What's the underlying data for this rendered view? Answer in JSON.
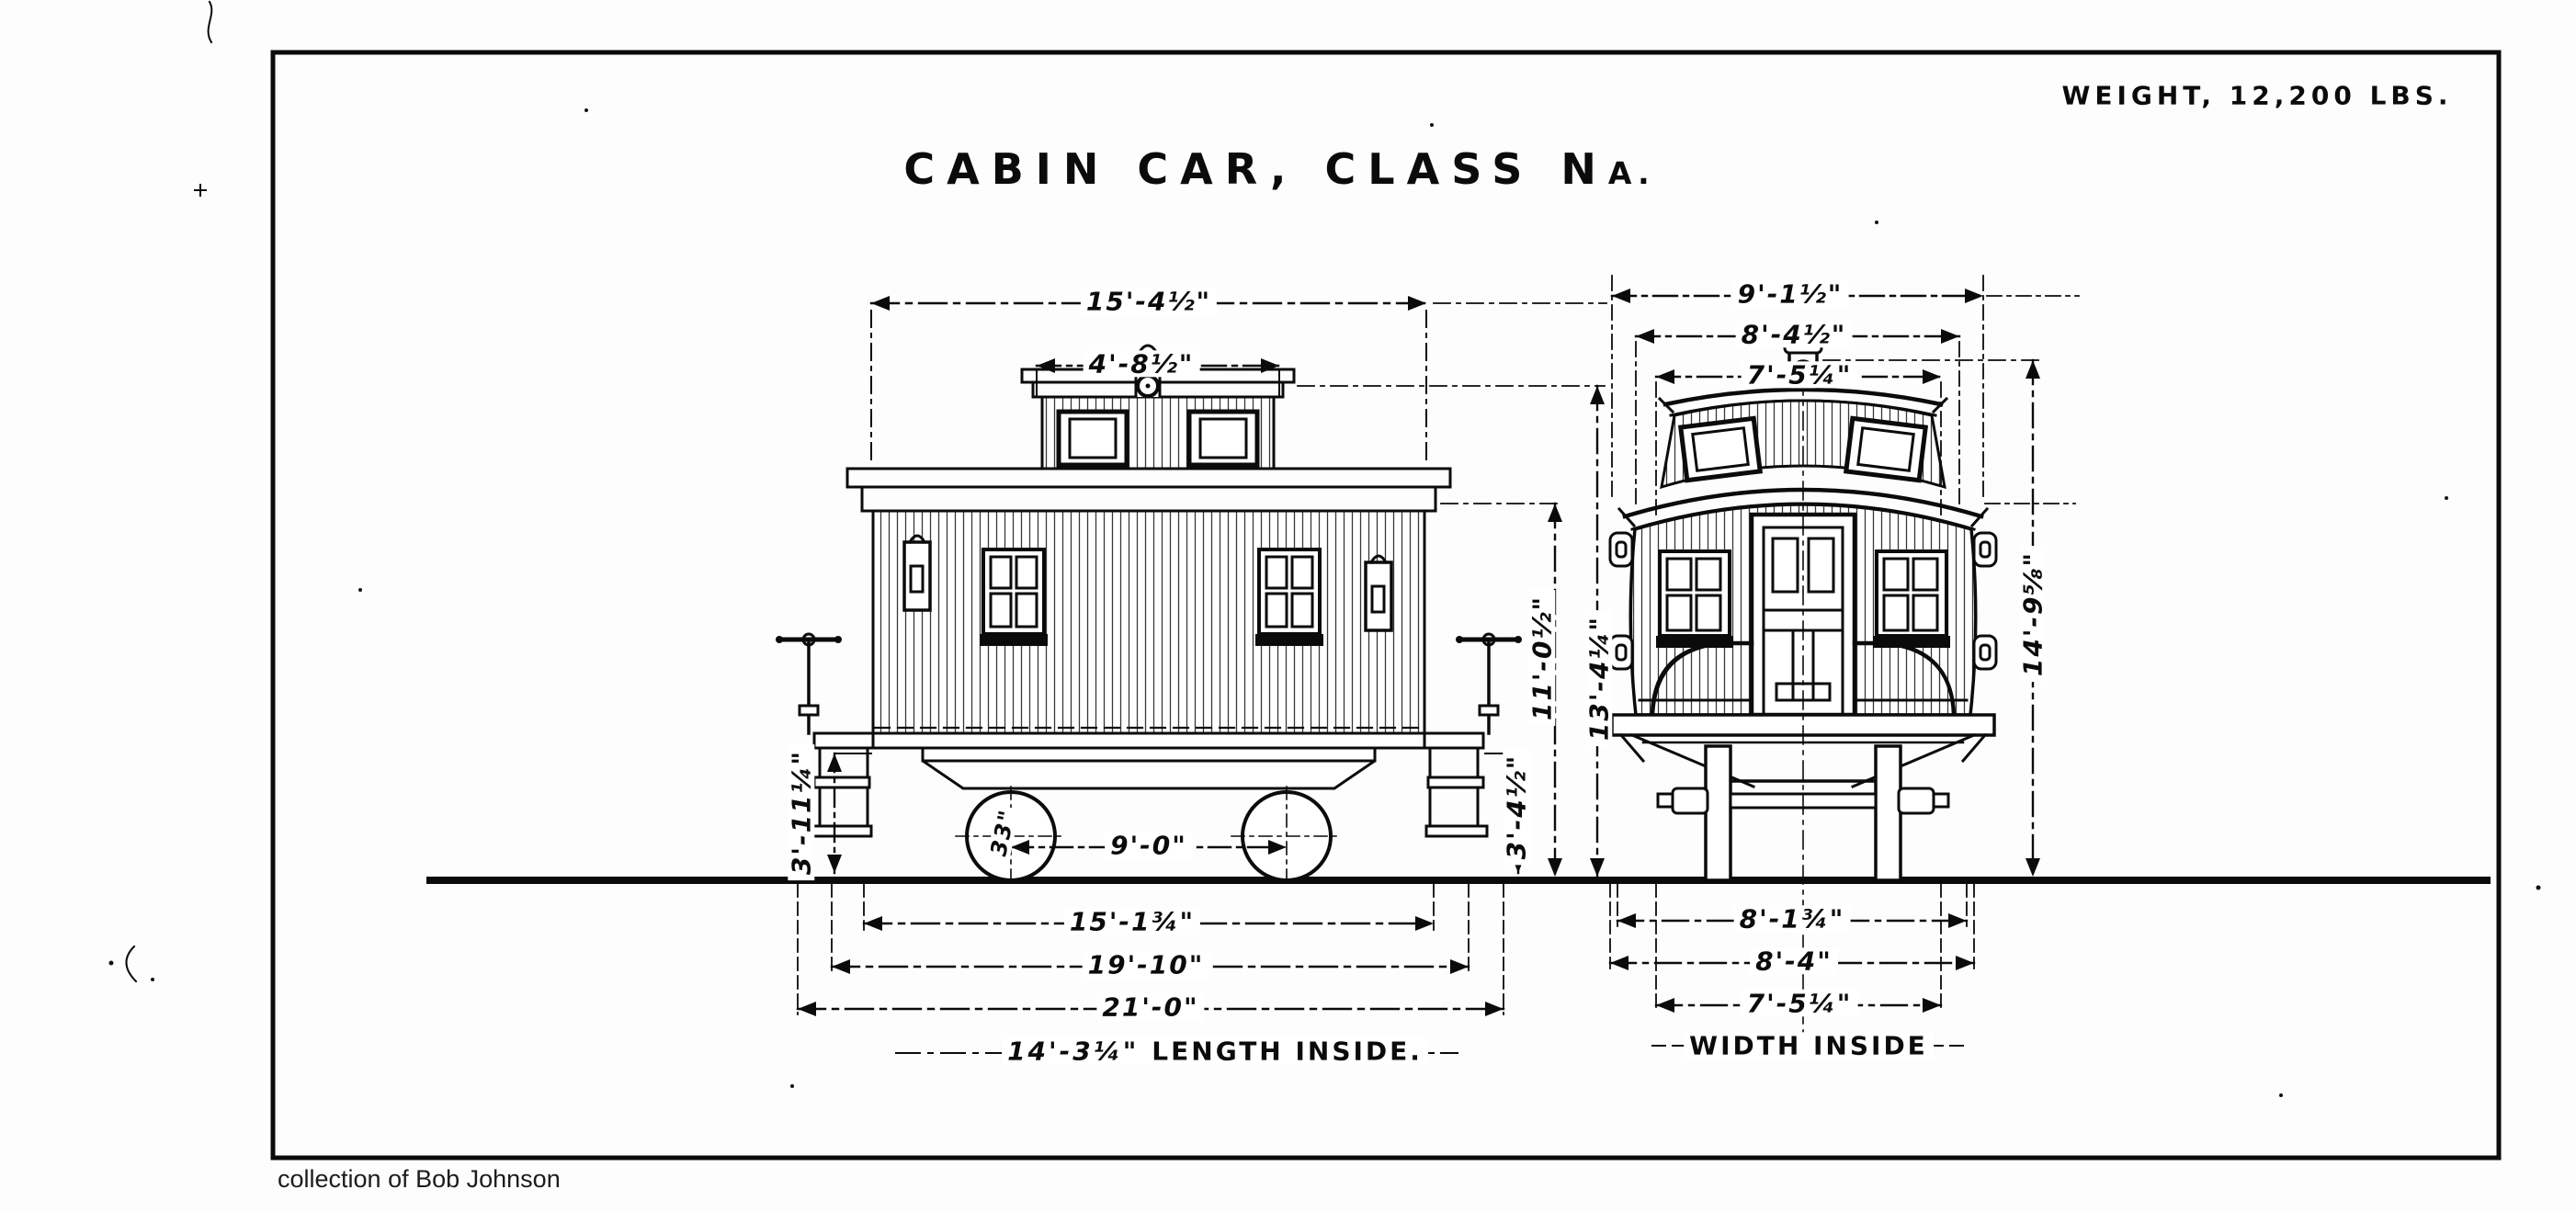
{
  "sheet": {
    "weight_note": "WEIGHT, 12,200 LBS.",
    "title_prefix": "CABIN CAR, CLASS N",
    "title_class_letter": "A.",
    "credit": "collection of Bob Johnson"
  },
  "side_view": {
    "name": "side elevation",
    "dims": {
      "roof_length": "15'-4½\"",
      "cupola_length": "4'-8½\"",
      "wheelbase": "9'-0\"",
      "wheel_diameter": "33\"",
      "frame_length": "15'-1¾\"",
      "over_platforms": "19'-10\"",
      "overall_length": "21'-0\"",
      "length_inside_value": "14'-3¼\"",
      "length_inside_label": "LENGTH INSIDE.",
      "left_height": "3'-11¼\"",
      "step_height": "3'-4½\"",
      "eaves_height": "11'-0½\"",
      "cupola_height": "13'-4¼\""
    }
  },
  "end_view": {
    "name": "end elevation",
    "dims": {
      "over_roof": "9'-1½\"",
      "over_eaves": "8'-4½\"",
      "cupola_top_width": "7'-5¼\"",
      "overall_height": "14'-9⅝\"",
      "over_sill": "8'-1¾\"",
      "body_width": "8'-4\"",
      "width_inside_value": "7'-5¼\"",
      "width_inside_label": "WIDTH INSIDE"
    }
  }
}
